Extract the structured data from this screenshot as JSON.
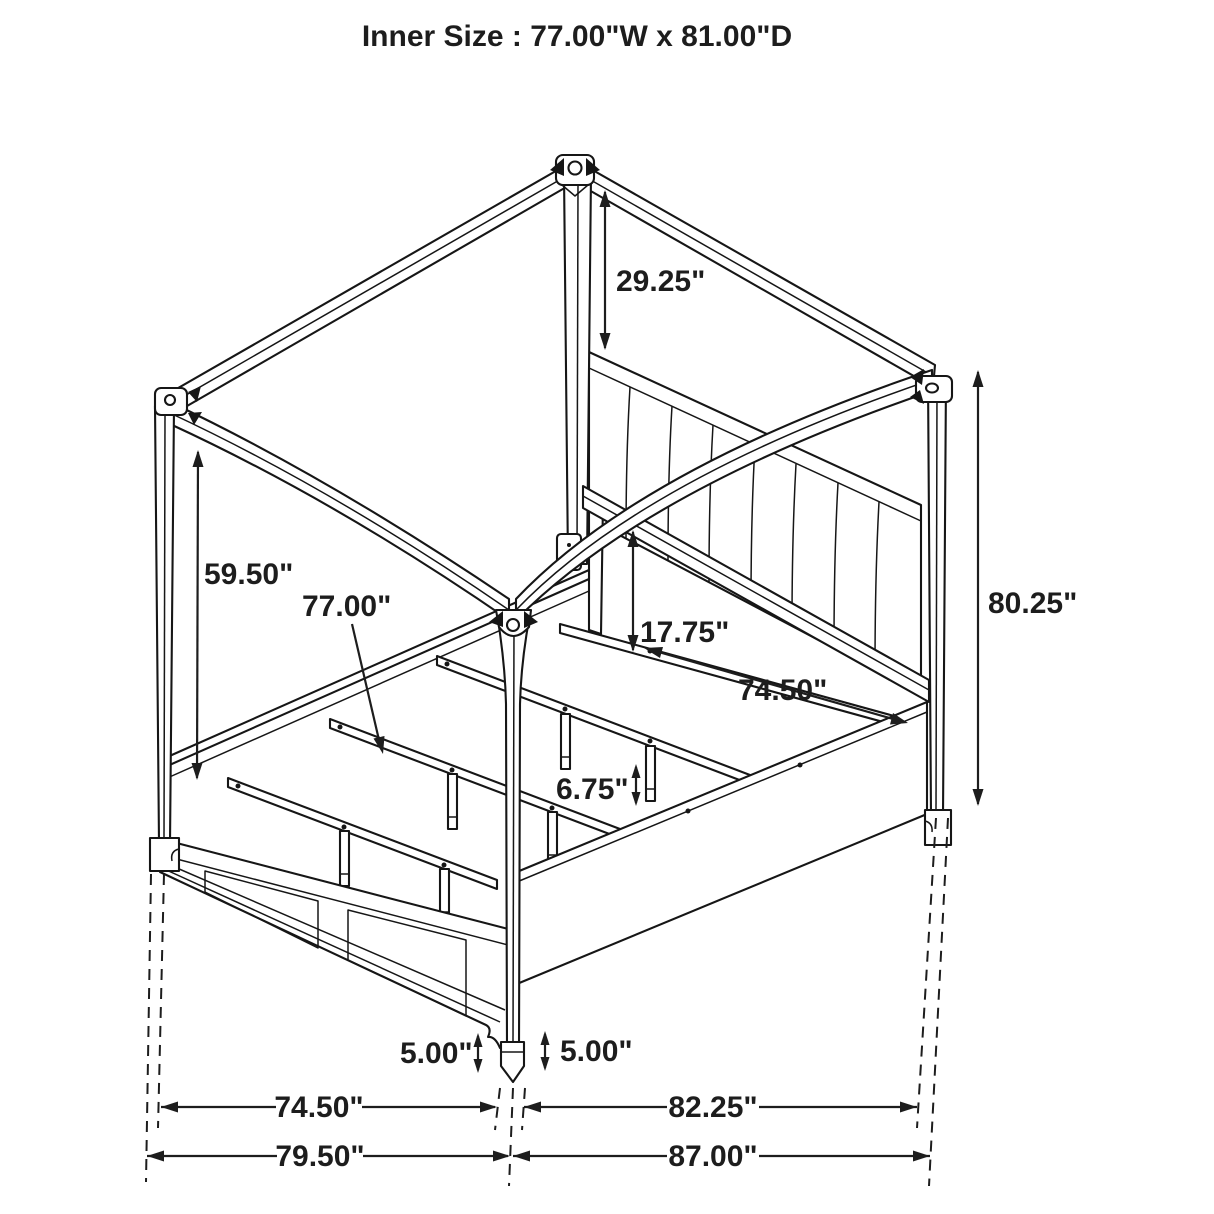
{
  "title": "Inner Size : 77.00\"W x 81.00\"D",
  "dimensions": {
    "post_top_to_headboard": "29.25\"",
    "canopy_clearance": "59.50\"",
    "slat_length": "77.00\"",
    "headboard_rail_to_canopy": "17.75\"",
    "side_inner_length": "74.50\"",
    "overall_height": "80.25\"",
    "slat_leg_height": "6.75\"",
    "left_foot_height": "5.00\"",
    "right_foot_height": "5.00\"",
    "inner_width": "74.50\"",
    "overall_width": "79.50\"",
    "inner_depth": "82.25\"",
    "overall_depth": "87.00\""
  },
  "colors": {
    "line_color": "#161616",
    "dim_color": "#1d1d1d",
    "background": "#ffffff"
  }
}
